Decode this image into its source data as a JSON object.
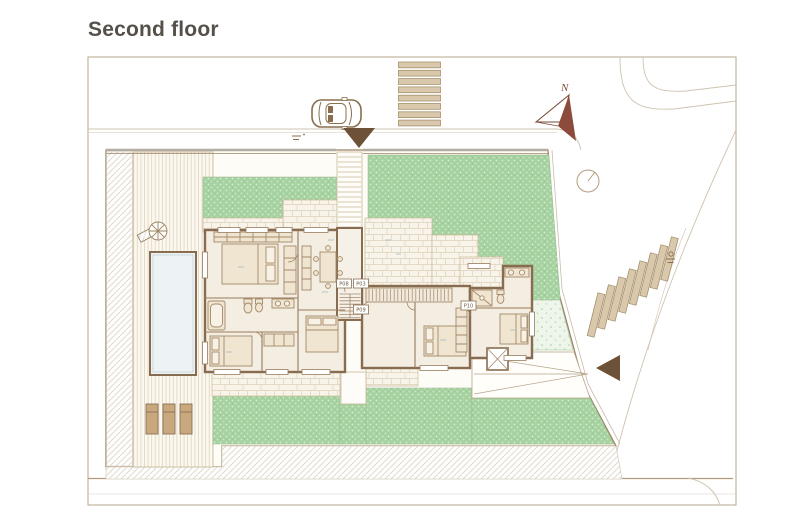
{
  "title": "Second floor",
  "compass": {
    "north_label": "N"
  },
  "badges": [
    {
      "label": "P08"
    },
    {
      "label": "P03"
    },
    {
      "label": "P09"
    },
    {
      "label": "P10"
    }
  ],
  "markers": {
    "entrance_arrow": "triangle-down",
    "driveway_arrow": "triangle-left"
  },
  "colors": {
    "title_text": "#55504a",
    "wall": "#876c4f",
    "lawn": "#a6d1a0",
    "lawn_light": "#eef6ec",
    "terrace_tile": "#f8f4ea",
    "deck": "#fbf8f0",
    "pool": "#edf2f5",
    "crosswalk_stripe": "#d9c8ab",
    "arrow": "#6d5138",
    "compass": "#8d4b3b",
    "road_line": "#cfc3b2",
    "frame": "#b7a58c",
    "interior": "#f3ede2",
    "furniture_fill": "#efe5d0",
    "hatch": "#dbd7d0"
  }
}
